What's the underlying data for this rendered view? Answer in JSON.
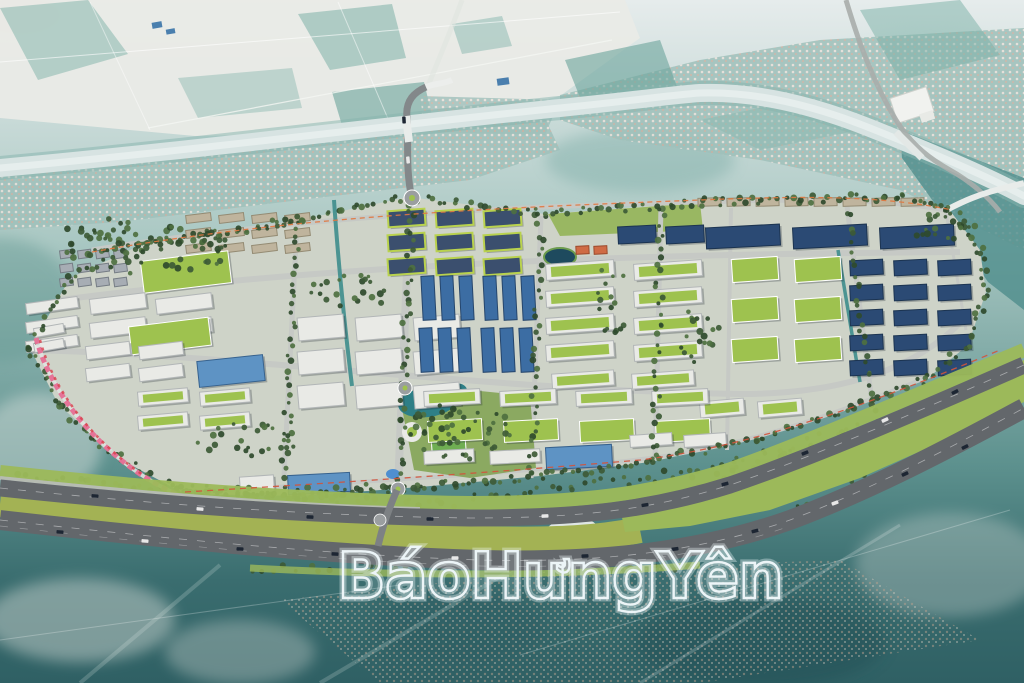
{
  "watermark": {
    "text": "BáoHưngYên",
    "outline_color": "#edf5f8"
  },
  "palette": {
    "satellite_light": "#e9ebe6",
    "satellite_teal": "#7fb2ab",
    "satellite_dark": "#2f6468",
    "river": "#d7e3e2",
    "water_teal": "#4f8d8c",
    "park_ground": "#ced3c8",
    "park_road": "#c6c9c5",
    "tree_green": "#3d5a36",
    "grass_green": "#9cb95a",
    "median_green": "#a3b254",
    "highway_gray": "#63676b",
    "roof_white": "#e9eae6",
    "roof_green": "#9ec24f",
    "roof_solar": "#3c6da3",
    "roof_navy": "#2b4a74",
    "roof_skyblue": "#5e93c4",
    "roof_tan": "#bfb49d",
    "roof_slate": "#a7adb4",
    "roof_lime_edge": "#b9d24e",
    "roof_orange": "#cf6b45",
    "canal_teal": "#3e8d8c",
    "flower_pink": "#e56e93",
    "boundary_orange": "#e07840"
  },
  "park": {
    "clusters": [
      {
        "name": "apartments-nw",
        "color": "tan",
        "x": 186,
        "y": 214,
        "cols": 4,
        "rows": 3,
        "w": 25,
        "h": 8,
        "gx": 8,
        "gy": 7,
        "rot": -7
      },
      {
        "name": "residential-nw",
        "color": "slate",
        "x": 60,
        "y": 250,
        "cols": 4,
        "rows": 3,
        "w": 13,
        "h": 8,
        "gx": 5,
        "gy": 6,
        "rot": -8
      },
      {
        "name": "greenroof-nw",
        "color": "green",
        "x": 142,
        "y": 256,
        "cols": 1,
        "rows": 1,
        "w": 88,
        "h": 32,
        "gx": 0,
        "gy": 0,
        "rot": -7
      },
      {
        "name": "white-w-rows",
        "color": "white",
        "x": 90,
        "y": 296,
        "cols": 2,
        "rows": 2,
        "w": 56,
        "h": 15,
        "gx": 10,
        "gy": 9,
        "rot": -7
      },
      {
        "name": "greenroof-w",
        "color": "green",
        "x": 130,
        "y": 322,
        "cols": 1,
        "rows": 1,
        "w": 80,
        "h": 28,
        "gx": 0,
        "gy": 0,
        "rot": -7
      },
      {
        "name": "white-sw-rows",
        "color": "white",
        "x": 26,
        "y": 300,
        "cols": 1,
        "rows": 3,
        "w": 52,
        "h": 11,
        "gx": 0,
        "gy": 8,
        "rot": -8
      },
      {
        "name": "white-sw2",
        "color": "white",
        "x": 86,
        "y": 344,
        "cols": 2,
        "rows": 2,
        "w": 44,
        "h": 13,
        "gx": 9,
        "gy": 9,
        "rot": -7
      },
      {
        "name": "skyblue-w",
        "color": "skyblue",
        "x": 198,
        "y": 358,
        "cols": 1,
        "rows": 1,
        "w": 66,
        "h": 26,
        "gx": 0,
        "gy": 0,
        "rot": -6
      },
      {
        "name": "greenroof-sw-rows",
        "color": "greenwhite",
        "x": 138,
        "y": 390,
        "cols": 2,
        "rows": 2,
        "w": 50,
        "h": 14,
        "gx": 12,
        "gy": 10,
        "rot": -5
      },
      {
        "name": "white-tip",
        "color": "white",
        "x": 34,
        "y": 326,
        "cols": 1,
        "rows": 2,
        "w": 30,
        "h": 9,
        "gx": 0,
        "gy": 6,
        "rot": -10
      },
      {
        "name": "white-grid-cl",
        "color": "white",
        "x": 298,
        "y": 316,
        "cols": 3,
        "rows": 3,
        "w": 46,
        "h": 23,
        "gx": 12,
        "gy": 11,
        "rot": -5
      },
      {
        "name": "lime-grid",
        "color": "lime",
        "x": 388,
        "y": 210,
        "cols": 3,
        "rows": 3,
        "w": 37,
        "h": 16,
        "gx": 11,
        "gy": 8,
        "rot": -4
      },
      {
        "name": "solar-c1",
        "color": "solar",
        "x": 422,
        "y": 276,
        "cols": 3,
        "rows": 1,
        "w": 13,
        "h": 44,
        "gx": 6,
        "gy": 0,
        "rot": -3
      },
      {
        "name": "solar-c2",
        "color": "solar",
        "x": 484,
        "y": 276,
        "cols": 3,
        "rows": 1,
        "w": 13,
        "h": 44,
        "gx": 6,
        "gy": 0,
        "rot": -3
      },
      {
        "name": "solar-c3",
        "color": "solar",
        "x": 420,
        "y": 328,
        "cols": 3,
        "rows": 1,
        "w": 13,
        "h": 44,
        "gx": 6,
        "gy": 0,
        "rot": -3
      },
      {
        "name": "solar-c4",
        "color": "solar",
        "x": 482,
        "y": 328,
        "cols": 3,
        "rows": 1,
        "w": 13,
        "h": 44,
        "gx": 6,
        "gy": 0,
        "rot": -3
      },
      {
        "name": "greenrow-center",
        "color": "greenwhite",
        "x": 546,
        "y": 262,
        "cols": 2,
        "rows": 4,
        "w": 68,
        "h": 16,
        "gx": 20,
        "gy": 11,
        "rot": -4
      },
      {
        "name": "greenrow-c2",
        "color": "greenwhite",
        "x": 552,
        "y": 372,
        "cols": 2,
        "rows": 1,
        "w": 62,
        "h": 15,
        "gx": 18,
        "gy": 0,
        "rot": -4
      },
      {
        "name": "utility-orange",
        "color": "orange",
        "x": 576,
        "y": 246,
        "cols": 2,
        "rows": 1,
        "w": 13,
        "h": 8,
        "gx": 5,
        "gy": 0,
        "rot": -3
      },
      {
        "name": "navy-pair",
        "color": "navy",
        "x": 618,
        "y": 226,
        "cols": 2,
        "rows": 1,
        "w": 38,
        "h": 17,
        "gx": 10,
        "gy": 0,
        "rot": -3
      },
      {
        "name": "navy-top-row",
        "color": "navy",
        "x": 706,
        "y": 226,
        "cols": 3,
        "rows": 1,
        "w": 74,
        "h": 21,
        "gx": 13,
        "gy": 0,
        "rot": -3
      },
      {
        "name": "shophouse-row",
        "color": "tan",
        "x": 698,
        "y": 198,
        "cols": 8,
        "rows": 1,
        "w": 23,
        "h": 8,
        "gx": 6,
        "gy": 0,
        "rot": -2
      },
      {
        "name": "greenroof-cr",
        "color": "green",
        "x": 732,
        "y": 258,
        "cols": 2,
        "rows": 3,
        "w": 46,
        "h": 23,
        "gx": 17,
        "gy": 17,
        "rot": -4
      },
      {
        "name": "navy-right",
        "color": "navy",
        "x": 850,
        "y": 260,
        "cols": 3,
        "rows": 5,
        "w": 33,
        "h": 15,
        "gx": 11,
        "gy": 10,
        "rot": -3
      },
      {
        "name": "greenroof-se",
        "color": "greenwhite",
        "x": 700,
        "y": 400,
        "cols": 2,
        "rows": 1,
        "w": 44,
        "h": 16,
        "gx": 14,
        "gy": 0,
        "rot": -5
      },
      {
        "name": "bottom-white",
        "color": "greenwhite",
        "x": 424,
        "y": 390,
        "cols": 4,
        "rows": 1,
        "w": 56,
        "h": 15,
        "gx": 20,
        "gy": 0,
        "rot": -3
      },
      {
        "name": "bottom-green",
        "color": "green",
        "x": 428,
        "y": 420,
        "cols": 4,
        "rows": 1,
        "w": 54,
        "h": 21,
        "gx": 22,
        "gy": 0,
        "rot": -3
      },
      {
        "name": "white-s",
        "color": "white",
        "x": 424,
        "y": 450,
        "cols": 2,
        "rows": 1,
        "w": 50,
        "h": 13,
        "gx": 16,
        "gy": 0,
        "rot": -3
      },
      {
        "name": "white-se",
        "color": "white",
        "x": 630,
        "y": 434,
        "cols": 2,
        "rows": 1,
        "w": 42,
        "h": 12,
        "gx": 12,
        "gy": 0,
        "rot": -4
      },
      {
        "name": "warehouse-gate",
        "color": "skyblue",
        "x": 546,
        "y": 446,
        "cols": 1,
        "rows": 1,
        "w": 66,
        "h": 22,
        "gx": 0,
        "gy": 0,
        "rot": -3
      },
      {
        "name": "solar-gate",
        "color": "skyblue",
        "x": 288,
        "y": 474,
        "cols": 1,
        "rows": 1,
        "w": 62,
        "h": 19,
        "gx": 0,
        "gy": 0,
        "rot": -3
      },
      {
        "name": "white-gate",
        "color": "white",
        "x": 240,
        "y": 476,
        "cols": 1,
        "rows": 1,
        "w": 34,
        "h": 18,
        "gx": 0,
        "gy": 0,
        "rot": -4
      }
    ]
  }
}
